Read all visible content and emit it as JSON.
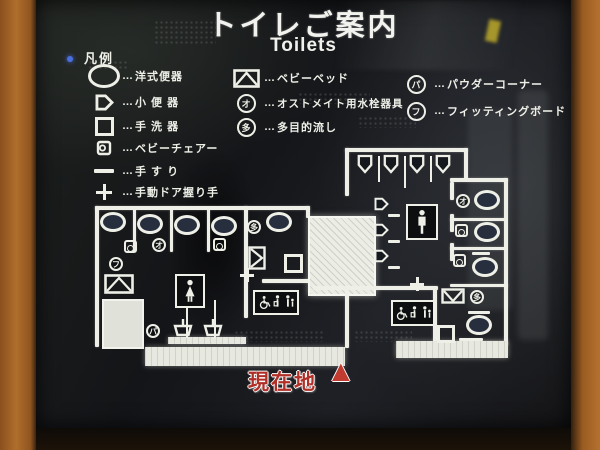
{
  "sign": {
    "title": "トイレご案内",
    "subtitle": "Toilets",
    "legend": {
      "header": "凡例",
      "dots": "…",
      "rows_left": [
        {
          "icon": "western-toilet-icon",
          "label": "洋式便器"
        },
        {
          "icon": "urinal-icon",
          "label": "小 便 器"
        },
        {
          "icon": "hand-basin-icon",
          "label": "手 洗 器"
        },
        {
          "icon": "baby-chair-icon",
          "label": "ベビーチェアー"
        },
        {
          "icon": "handrail-icon",
          "label": "手 す り"
        },
        {
          "icon": "manual-door-handle-icon",
          "label": "手動ドア握り手"
        }
      ],
      "rows_middle": [
        {
          "icon": "baby-bed-icon",
          "label": "ベビーベッド"
        },
        {
          "icon": "ostomate-circle-icon",
          "glyph": "オ",
          "label": "オストメイト用水栓器具"
        },
        {
          "icon": "multipurpose-sink-circle-icon",
          "glyph": "多",
          "label": "多目的流し"
        }
      ],
      "rows_right": [
        {
          "icon": "powder-corner-circle-icon",
          "glyph": "パ",
          "label": "パウダーコーナー"
        },
        {
          "icon": "fitting-board-circle-icon",
          "glyph": "フ",
          "label": "フィッティングボード"
        }
      ]
    },
    "plan_markers": {
      "ostomate": "オ",
      "multipurpose": "多",
      "powder": "パ",
      "fitting": "フ"
    },
    "current_location": {
      "label": "現在地",
      "marker": "▲"
    },
    "colors": {
      "sign_black": "#141518",
      "line_white": "#eef0e8",
      "wall_orange": "#b06e2c",
      "accent_red": "#b03028"
    }
  }
}
